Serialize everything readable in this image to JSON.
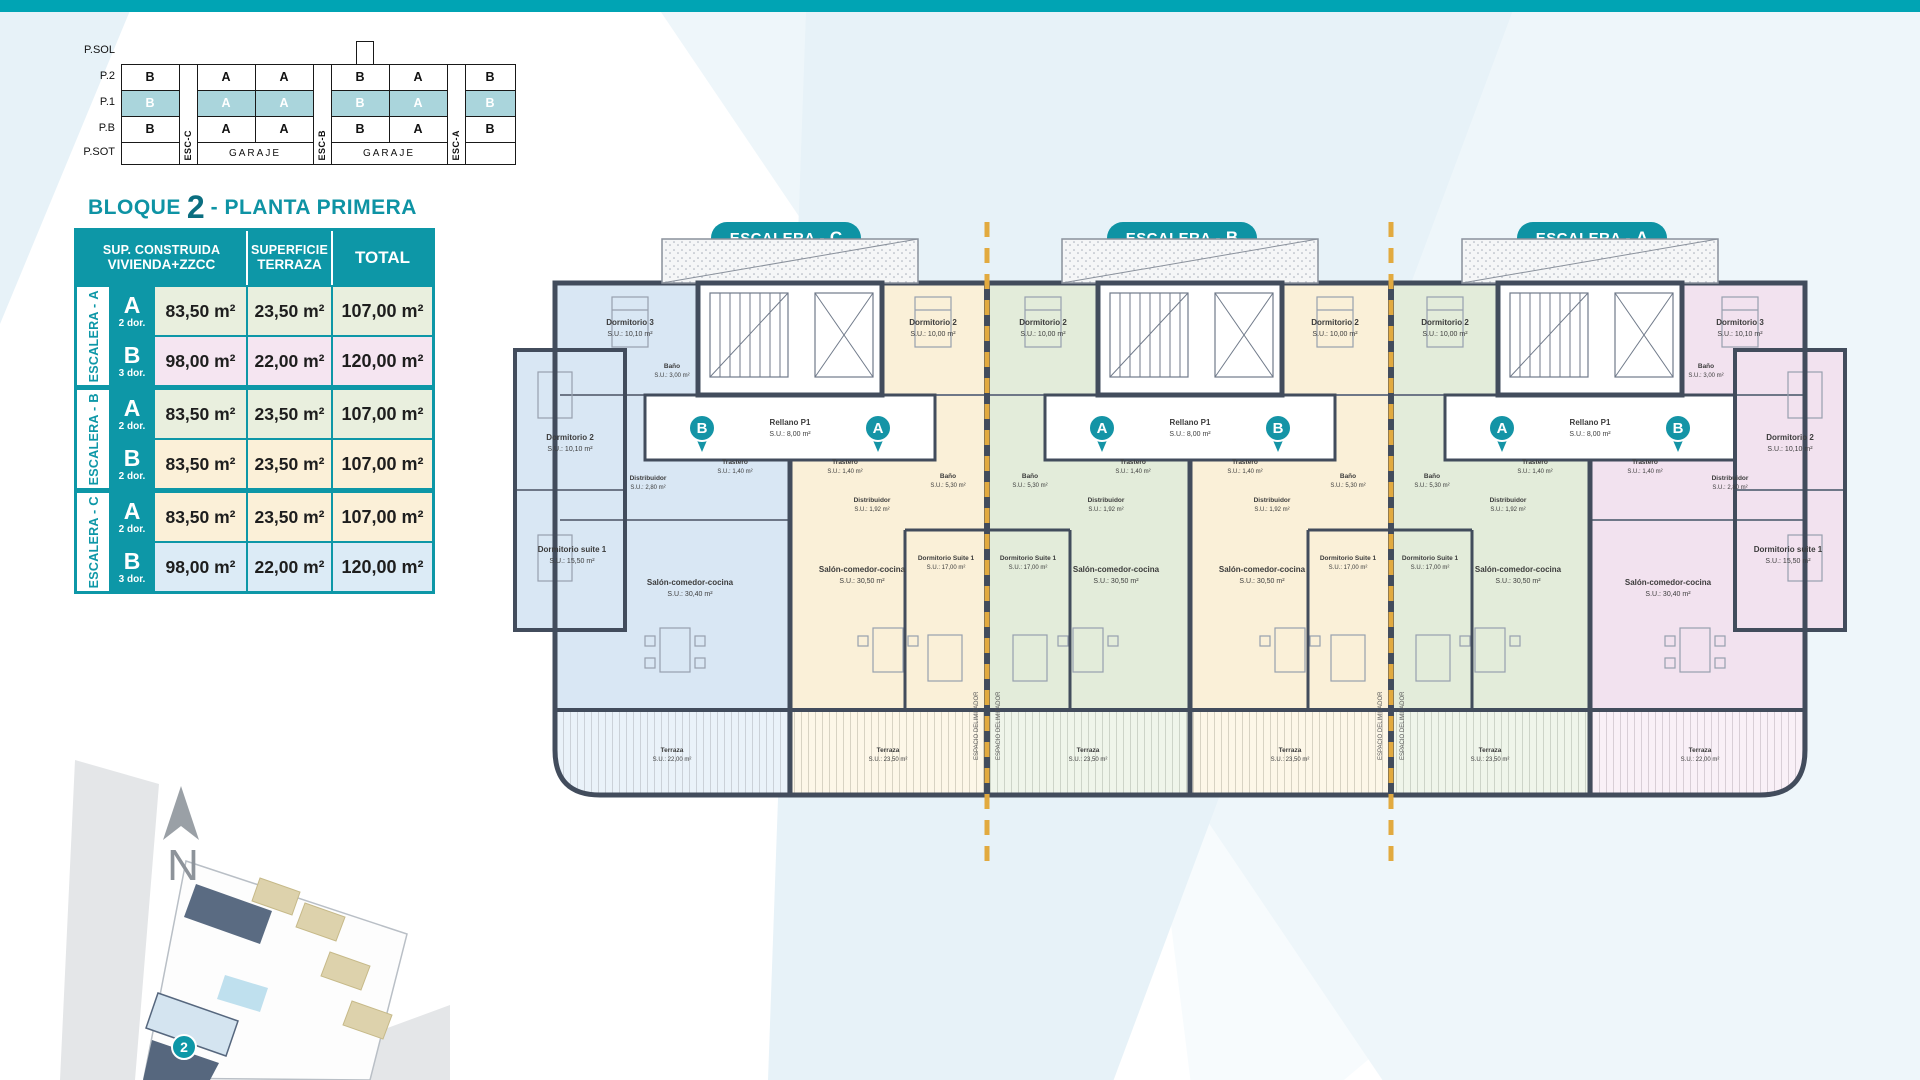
{
  "colors": {
    "accent_teal": "#0d97a7",
    "topbar_teal": "#00a4b4",
    "highlight_row": "#aad5dc",
    "dashed_separator": "#e2aa3f",
    "wall": "#424c5c",
    "unit_blue": "#d9e7f4",
    "unit_cream": "#faf0d8",
    "unit_green": "#e3ecda",
    "unit_pink": "#f2e2ef"
  },
  "section_diagram": {
    "floors": [
      "P.SOL",
      "P.2",
      "P.1",
      "P.B",
      "P.SOT"
    ],
    "esc_labels": [
      "ESC-C",
      "ESC-B",
      "ESC-A"
    ],
    "rows": {
      "p2": [
        "B",
        "A",
        "A",
        "B",
        "A",
        "B"
      ],
      "p1": [
        "B",
        "A",
        "A",
        "B",
        "A",
        "B"
      ],
      "pb": [
        "B",
        "A",
        "A",
        "B",
        "A",
        "B"
      ]
    },
    "garaje": [
      "GARAJE",
      "GARAJE"
    ]
  },
  "title": {
    "block_word": "BLOQUE",
    "block_number": "2",
    "plant": "- PLANTA PRIMERA"
  },
  "area_table": {
    "headers": {
      "col1_line1": "SUP. CONSTRUIDA",
      "col1_line2": "VIVIENDA+ZZCC",
      "col2_line1": "SUPERFICIE",
      "col2_line2": "TERRAZA",
      "col3": "TOTAL"
    },
    "groups": [
      {
        "prefix": "ESCALERA - ",
        "letter": "A",
        "rows": [
          {
            "letter": "A",
            "dorms": "2 dor.",
            "sup": "83,50 m²",
            "terraza": "23,50 m²",
            "total": "107,00 m²"
          },
          {
            "letter": "B",
            "dorms": "3 dor.",
            "sup": "98,00 m²",
            "terraza": "22,00 m²",
            "total": "120,00 m²"
          }
        ]
      },
      {
        "prefix": "ESCALERA - ",
        "letter": "B",
        "rows": [
          {
            "letter": "A",
            "dorms": "2 dor.",
            "sup": "83,50 m²",
            "terraza": "23,50 m²",
            "total": "107,00 m²"
          },
          {
            "letter": "B",
            "dorms": "2 dor.",
            "sup": "83,50 m²",
            "terraza": "23,50 m²",
            "total": "107,00 m²"
          }
        ]
      },
      {
        "prefix": "ESCALERA - ",
        "letter": "C",
        "rows": [
          {
            "letter": "A",
            "dorms": "2 dor.",
            "sup": "83,50 m²",
            "terraza": "23,50 m²",
            "total": "107,00 m²"
          },
          {
            "letter": "B",
            "dorms": "3 dor.",
            "sup": "98,00 m²",
            "terraza": "22,00 m²",
            "total": "120,00 m²"
          }
        ]
      }
    ]
  },
  "plan": {
    "badges": [
      {
        "prefix": "ESCALERA -",
        "letter": "C"
      },
      {
        "prefix": "ESCALERA -",
        "letter": "B"
      },
      {
        "prefix": "ESCALERA -",
        "letter": "A"
      }
    ],
    "rellano": {
      "name": "Rellano P1",
      "su": "S.U.: 8,00 m²"
    },
    "separator_note": "ESPACIO DELIMITADOR",
    "units": [
      {
        "id": "C-B",
        "circle": "B",
        "dorm3": "Dormitorio 3",
        "dorm3_su": "S.U.: 10,10 m²",
        "bano": "Baño",
        "bano_su": "S.U.: 3,00 m²",
        "dist": "Distribuidor",
        "dist_su": "S.U.: 2,80 m²",
        "dorm2": "Dormitorio 2",
        "dorm2_su": "S.U.: 10,10 m²",
        "suite": "Dormitorio suite 1",
        "suite_su": "S.U.: 15,50 m²",
        "trastero": "Trastero",
        "trastero_su": "S.U.: 1,40 m²",
        "salon": "Salón-comedor-cocina",
        "salon_su": "S.U.: 30,40 m²",
        "terraza": "Terraza",
        "terraza_su": "S.U.: 22,00 m²"
      },
      {
        "id": "C-A",
        "circle": "A",
        "dorm2": "Dormitorio 2",
        "dorm2_su": "S.U.: 10,00 m²",
        "bano": "Baño",
        "bano_su": "S.U.: 5,30 m²",
        "dist": "Distribuidor",
        "dist_su": "S.U.: 1,92 m²",
        "trastero": "Trastero",
        "trastero_su": "S.U.: 1,40 m²",
        "suite": "Dormitorio Suite 1",
        "suite_su": "S.U.: 17,00 m²",
        "salon": "Salón-comedor-cocina",
        "salon_su": "S.U.: 30,50 m²",
        "terraza": "Terraza",
        "terraza_su": "S.U.: 23,50 m²"
      },
      {
        "id": "B-A",
        "circle": "A",
        "dorm2": "Dormitorio 2",
        "dorm2_su": "S.U.: 10,00 m²",
        "bano": "Baño",
        "bano_su": "S.U.: 5,30 m²",
        "dist": "Distribuidor",
        "dist_su": "S.U.: 1,92 m²",
        "trastero": "Trastero",
        "trastero_su": "S.U.: 1,40 m²",
        "suite": "Dormitorio Suite 1",
        "suite_su": "S.U.: 17,00 m²",
        "salon": "Salón-comedor-cocina",
        "salon_su": "S.U.: 30,50 m²",
        "terraza": "Terraza",
        "terraza_su": "S.U.: 23,50 m²"
      },
      {
        "id": "B-B",
        "circle": "B",
        "dorm2": "Dormitorio 2",
        "dorm2_su": "S.U.: 10,00 m²",
        "bano": "Baño",
        "bano_su": "S.U.: 5,30 m²",
        "dist": "Distribuidor",
        "dist_su": "S.U.: 1,92 m²",
        "trastero": "Trastero",
        "trastero_su": "S.U.: 1,40 m²",
        "suite": "Dormitorio Suite 1",
        "suite_su": "S.U.: 17,00 m²",
        "salon": "Salón-comedor-cocina",
        "salon_su": "S.U.: 30,50 m²",
        "terraza": "Terraza",
        "terraza_su": "S.U.: 23,50 m²"
      },
      {
        "id": "A-A",
        "circle": "A",
        "dorm2": "Dormitorio 2",
        "dorm2_su": "S.U.: 10,00 m²",
        "bano": "Baño",
        "bano_su": "S.U.: 5,30 m²",
        "dist": "Distribuidor",
        "dist_su": "S.U.: 1,92 m²",
        "trastero": "Trastero",
        "trastero_su": "S.U.: 1,40 m²",
        "suite": "Dormitorio Suite 1",
        "suite_su": "S.U.: 17,00 m²",
        "salon": "Salón-comedor-cocina",
        "salon_su": "S.U.: 30,50 m²",
        "terraza": "Terraza",
        "terraza_su": "S.U.: 23,50 m²"
      },
      {
        "id": "A-B",
        "circle": "B",
        "dorm3": "Dormitorio 3",
        "dorm3_su": "S.U.: 10,10 m²",
        "bano": "Baño",
        "bano_su": "S.U.: 3,00 m²",
        "dist": "Distribuidor",
        "dist_su": "S.U.: 2,80 m²",
        "dorm2": "Dormitorio 2",
        "dorm2_su": "S.U.: 10,10 m²",
        "suite": "Dormitorio suite 1",
        "suite_su": "S.U.: 15,50 m²",
        "trastero": "Trastero",
        "trastero_su": "S.U.: 1,40 m²",
        "salon": "Salón-comedor-cocina",
        "salon_su": "S.U.: 30,40 m²",
        "terraza": "Terraza",
        "terraza_su": "S.U.: 22,00 m²"
      }
    ]
  },
  "site_plan": {
    "north": "N",
    "block_marker": "2"
  }
}
